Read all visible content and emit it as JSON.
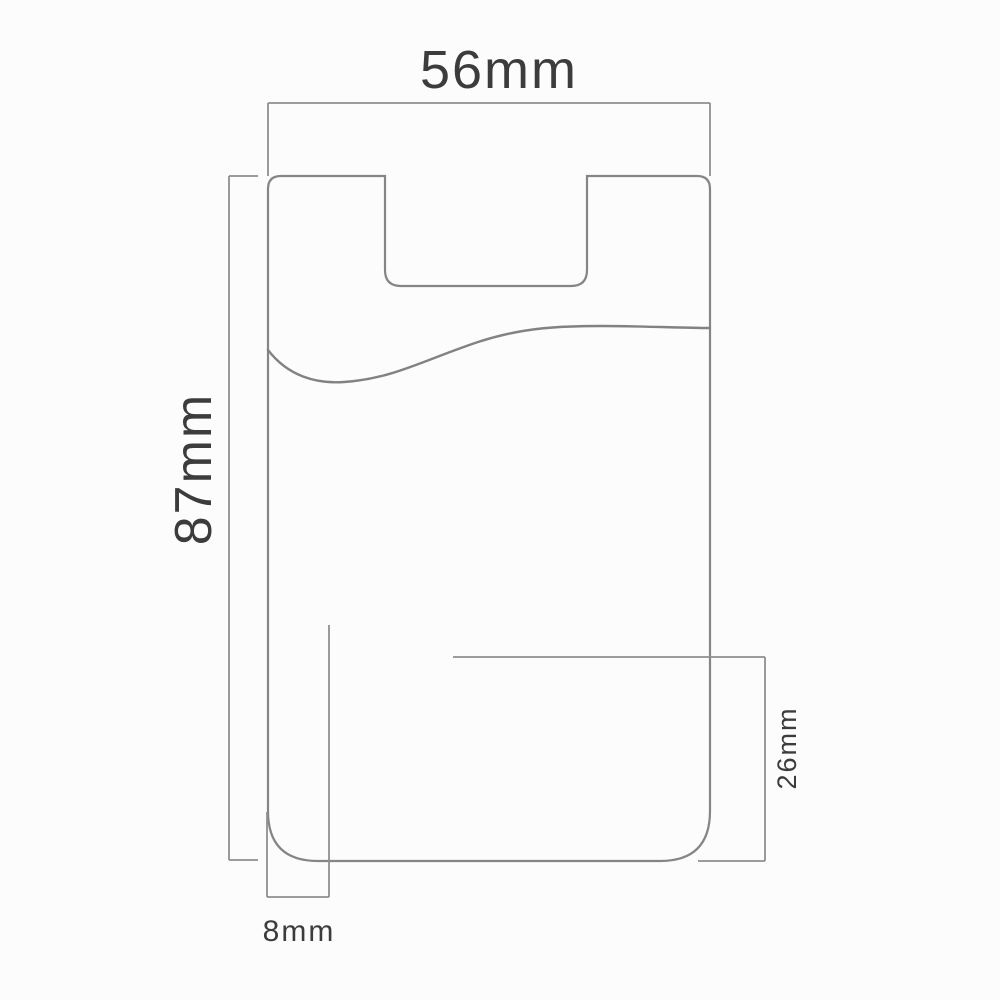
{
  "diagram": {
    "object": "phone-card-sleeve-dimension-drawing",
    "measurements": {
      "overall_width": {
        "label": "56mm",
        "value": 56,
        "unit": "mm",
        "orientation": "horizontal-top"
      },
      "overall_height": {
        "label": "87mm",
        "value": 87,
        "unit": "mm",
        "orientation": "vertical-left"
      },
      "bottom_side_width": {
        "label": "8mm",
        "value": 8,
        "unit": "mm",
        "orientation": "horizontal-bottom"
      },
      "lower_section_height": {
        "label": "26mm",
        "value": 26,
        "unit": "mm",
        "orientation": "vertical-right"
      }
    },
    "colors": {
      "line": "#858585",
      "dimension_line": "#8f8f8f",
      "text": "#3c3c3c",
      "background": "#fcfcfc"
    }
  }
}
